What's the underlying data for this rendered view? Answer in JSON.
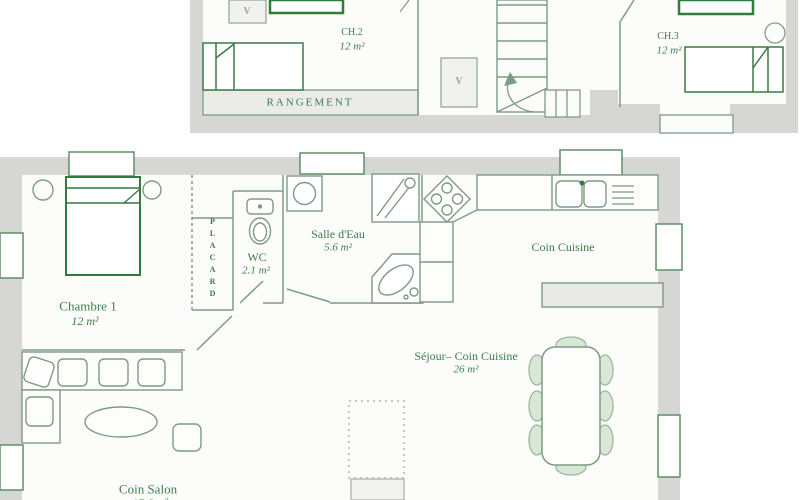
{
  "document": {
    "type": "floor-plan",
    "levels": [
      "upper",
      "ground"
    ]
  },
  "plans": {
    "upper": {
      "rooms": {
        "ch2": {
          "name": "CH.2",
          "area": "12 m²"
        },
        "ch3": {
          "name": "CH.3",
          "area": "12 m²"
        },
        "rangement": {
          "name": "RANGEMENT"
        }
      },
      "symbols": {
        "velux": "V"
      }
    },
    "ground": {
      "rooms": {
        "chambre1": {
          "name": "Chambre 1",
          "area": "12 m²"
        },
        "placard": {
          "name": "PLACARD"
        },
        "wc": {
          "name": "WC",
          "area": "2.1 m²"
        },
        "salle_eau": {
          "name": "Salle d'Eau",
          "area": "5.6 m²"
        },
        "coin_cuisine": {
          "name": "Coin Cuisine"
        },
        "sejour": {
          "name": "Séjour– Coin Cuisine",
          "area": "26 m²"
        },
        "coin_salon": {
          "name": "Coin Salon",
          "area": "17.6 m²"
        }
      }
    }
  },
  "colors": {
    "wall_gray": "#d6d6d4",
    "line_green": "#7d9c82",
    "dark_green": "#2f7c3c",
    "text_green": "#3d7d4b",
    "light_fill": "#ebebe9"
  }
}
